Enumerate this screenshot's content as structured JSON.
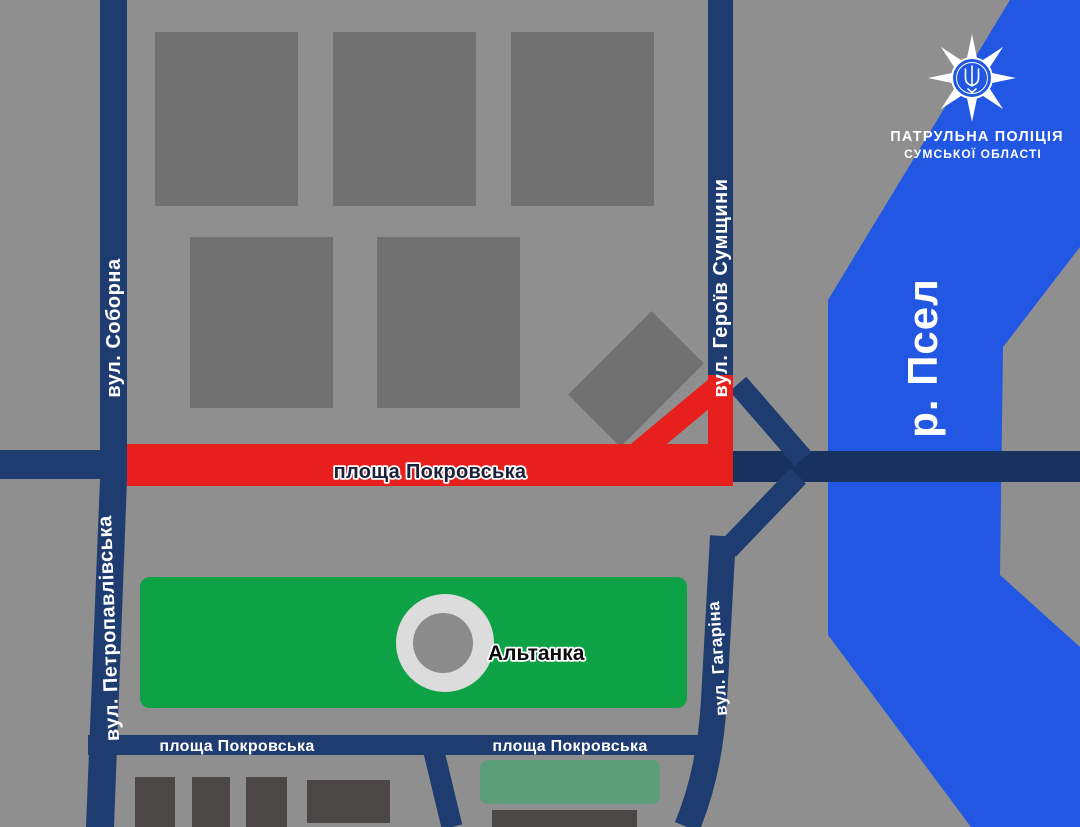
{
  "logo": {
    "line1": "ПАТРУЛЬНА ПОЛІЦІЯ",
    "line2": "СУМСЬКОЇ ОБЛАСТІ"
  },
  "icons": {
    "police_badge": "eight-point-star-badge-with-trident",
    "gazebo_marker": "circle-gazebo-marker"
  },
  "map": {
    "river_label": "р. Псел",
    "park_marker_label": "Альтанка",
    "closed_section_label": "площа Покровська",
    "street_labels": {
      "soborna": "вул. Соборна",
      "petropavlivska": "вул. Петропавлівська",
      "heroiv_sumshchyny": "вул. Героїв Сумщини",
      "haharina": "вул. Гагаріна"
    },
    "square_labels": {
      "left": "площа Покровська",
      "center": "площа Покровська"
    }
  },
  "colors": {
    "background": "#8f8f8f",
    "building_gray": "#717171",
    "building_dark": "#4b4747",
    "building_sage": "#5c9e7a",
    "park_green": "#0da246",
    "marker_outer": "#dddcdc",
    "marker_inner": "#8b8b8b",
    "road": "#1f3c70",
    "bridge": "#17325e",
    "closure_red": "#e7201d",
    "river_blue": "#2257e4",
    "badge_blue": "#2257e4"
  }
}
